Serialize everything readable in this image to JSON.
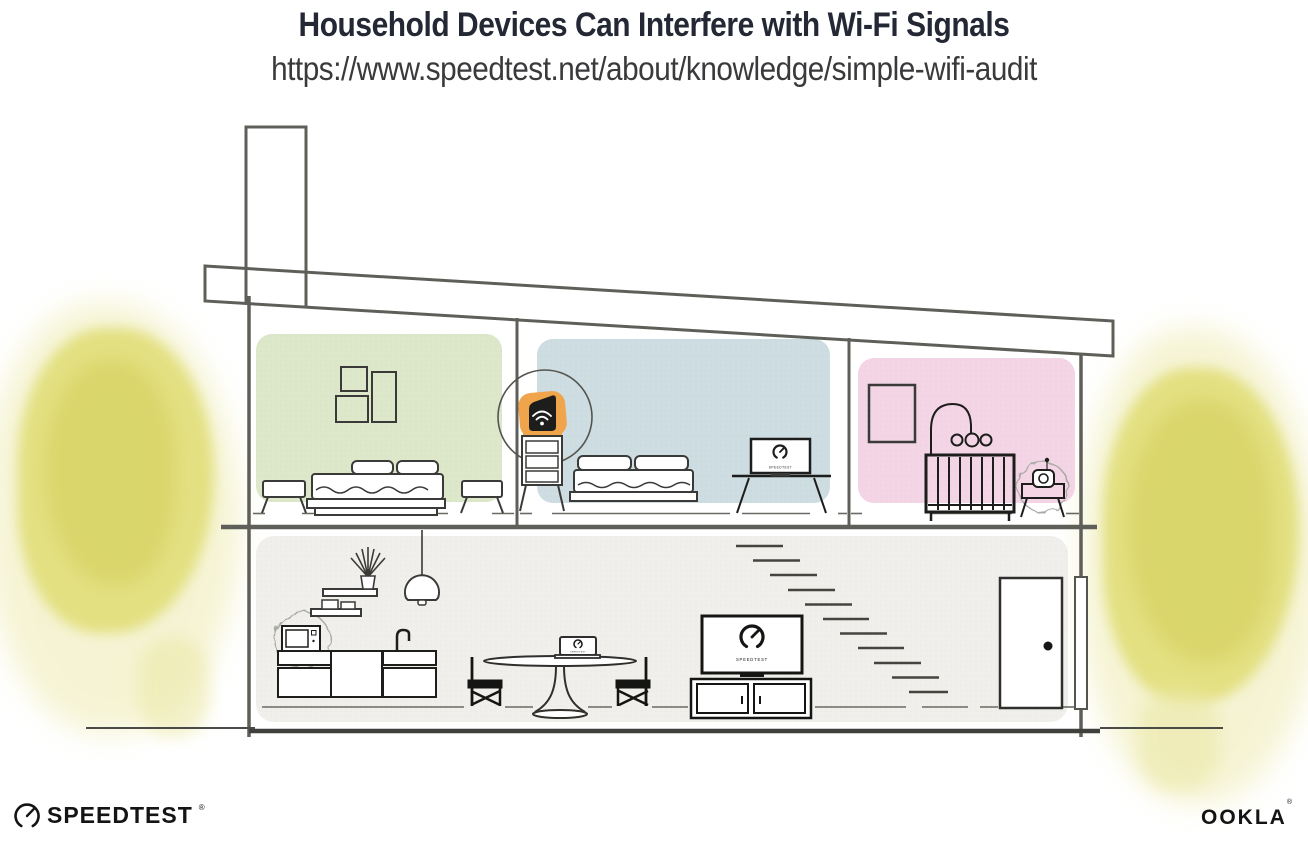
{
  "header": {
    "title": "Household Devices Can Interfere with Wi-Fi Signals",
    "url": "https://www.speedtest.net/about/knowledge/simple-wifi-audit"
  },
  "illustration": {
    "tv_bedroom_label": "SPEEDTEST",
    "tv_living_label": "SPEEDTEST",
    "laptop_label": "SPEEDTEST"
  },
  "footer": {
    "speedtest_label": "SPEEDTEST",
    "speedtest_reg": "®",
    "ookla_label": "OOKLA",
    "ookla_reg": "®"
  },
  "colors": {
    "title_text": "#232834",
    "url_text": "#3a3a3c",
    "structure_gray": "#5f5f5a",
    "furniture_dark": "#151513",
    "wall_green": "#dce8c9",
    "wall_blue": "#cddde1",
    "wall_pink": "#f3d5e5",
    "floor_gray": "#f0efeb",
    "tree_yellow": "#e0dd74",
    "router_orange": "#f0a44b",
    "burst_gray": "#a9a9a5",
    "logo_black": "#141414"
  }
}
